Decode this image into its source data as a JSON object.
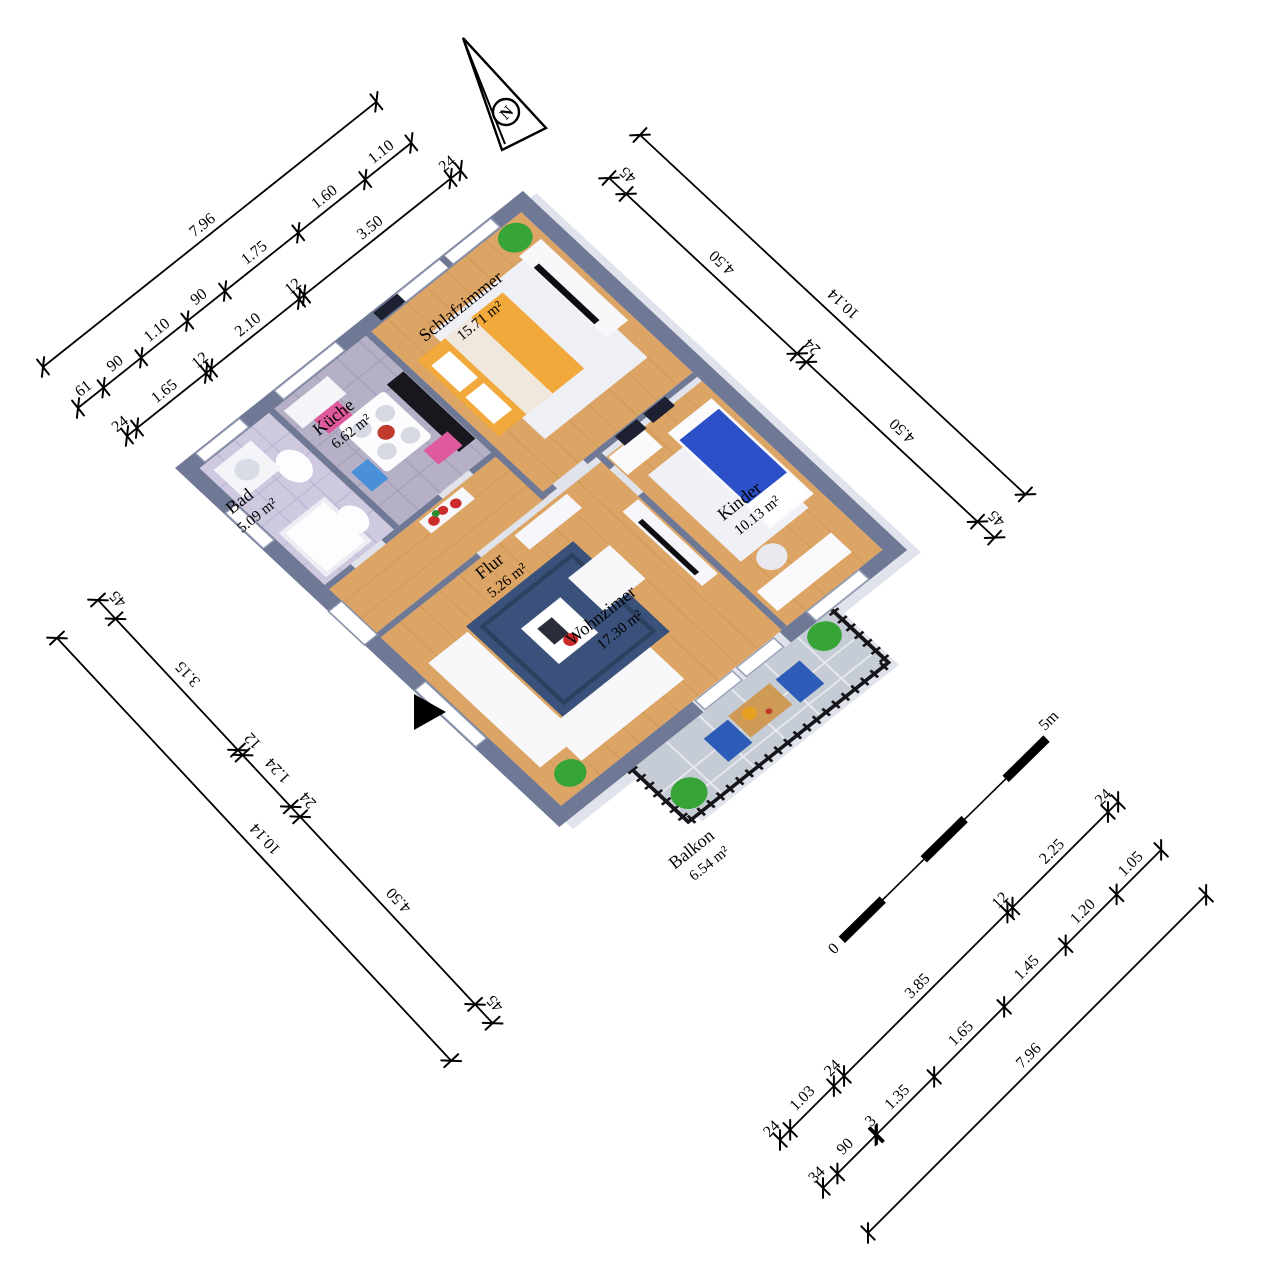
{
  "plan": {
    "kind": "3d-floor-plan-rendering",
    "north_indicator": {
      "letter": "N"
    },
    "scale_bar": {
      "zero": "0",
      "end": "5m"
    }
  },
  "rooms": {
    "schlafzimmer": {
      "name": "Schlafzimmer",
      "area": "15.71 m²"
    },
    "kueche": {
      "name": "Küche",
      "area": "6.62 m²"
    },
    "bad": {
      "name": "Bad",
      "area": "5.09 m²"
    },
    "flur": {
      "name": "Flur",
      "area": "5.26 m²"
    },
    "wohnzimmer": {
      "name": "Wohnzimer",
      "area": "17.30 m²"
    },
    "kinder": {
      "name": "Kinder",
      "area": "10.13 m²"
    },
    "balkon": {
      "name": "Balkon",
      "area": "6.54 m²"
    }
  },
  "dims": {
    "tl": {
      "l1": [
        "7.96"
      ],
      "l2": [
        "61",
        "90",
        "1.10",
        "90",
        "1.75",
        "1.60",
        "1.10"
      ],
      "l3": [
        "24",
        "1.65",
        "12",
        "2.10",
        "12",
        "3.50",
        "24"
      ]
    },
    "tr": {
      "outer": [
        "10.14"
      ],
      "inner": [
        "45",
        "4.50",
        "24",
        "4.50",
        "45"
      ]
    },
    "bl": {
      "outer": [
        "10.14"
      ],
      "inner": [
        "45",
        "3.15",
        "12",
        "1.24",
        "24",
        "4.50",
        "45"
      ]
    },
    "br": {
      "inner": [
        "24",
        "1.03",
        "24",
        "3.85",
        "12",
        "2.25",
        "24"
      ],
      "mid": [
        "34",
        "90",
        "3",
        "1.35",
        "1.65",
        "1.45",
        "1.20",
        "1.05"
      ],
      "outer": [
        "7.96"
      ]
    }
  },
  "colors": {
    "wall": "#6f7894",
    "wood": "#dca566",
    "rug_blue": "#39517b",
    "tile_bad": "#cfc9e0",
    "tile_kueche": "#b6b0c6",
    "tile_balkon": "#c6ccd6",
    "bed_orange": "#f2a93b",
    "bed_blue": "#2b50c8",
    "chair_pink": "#df5a9c",
    "balkon_chair_blue": "#2c5cb8",
    "plant_green": "#37a437",
    "shadow": "#e0e3eb"
  }
}
